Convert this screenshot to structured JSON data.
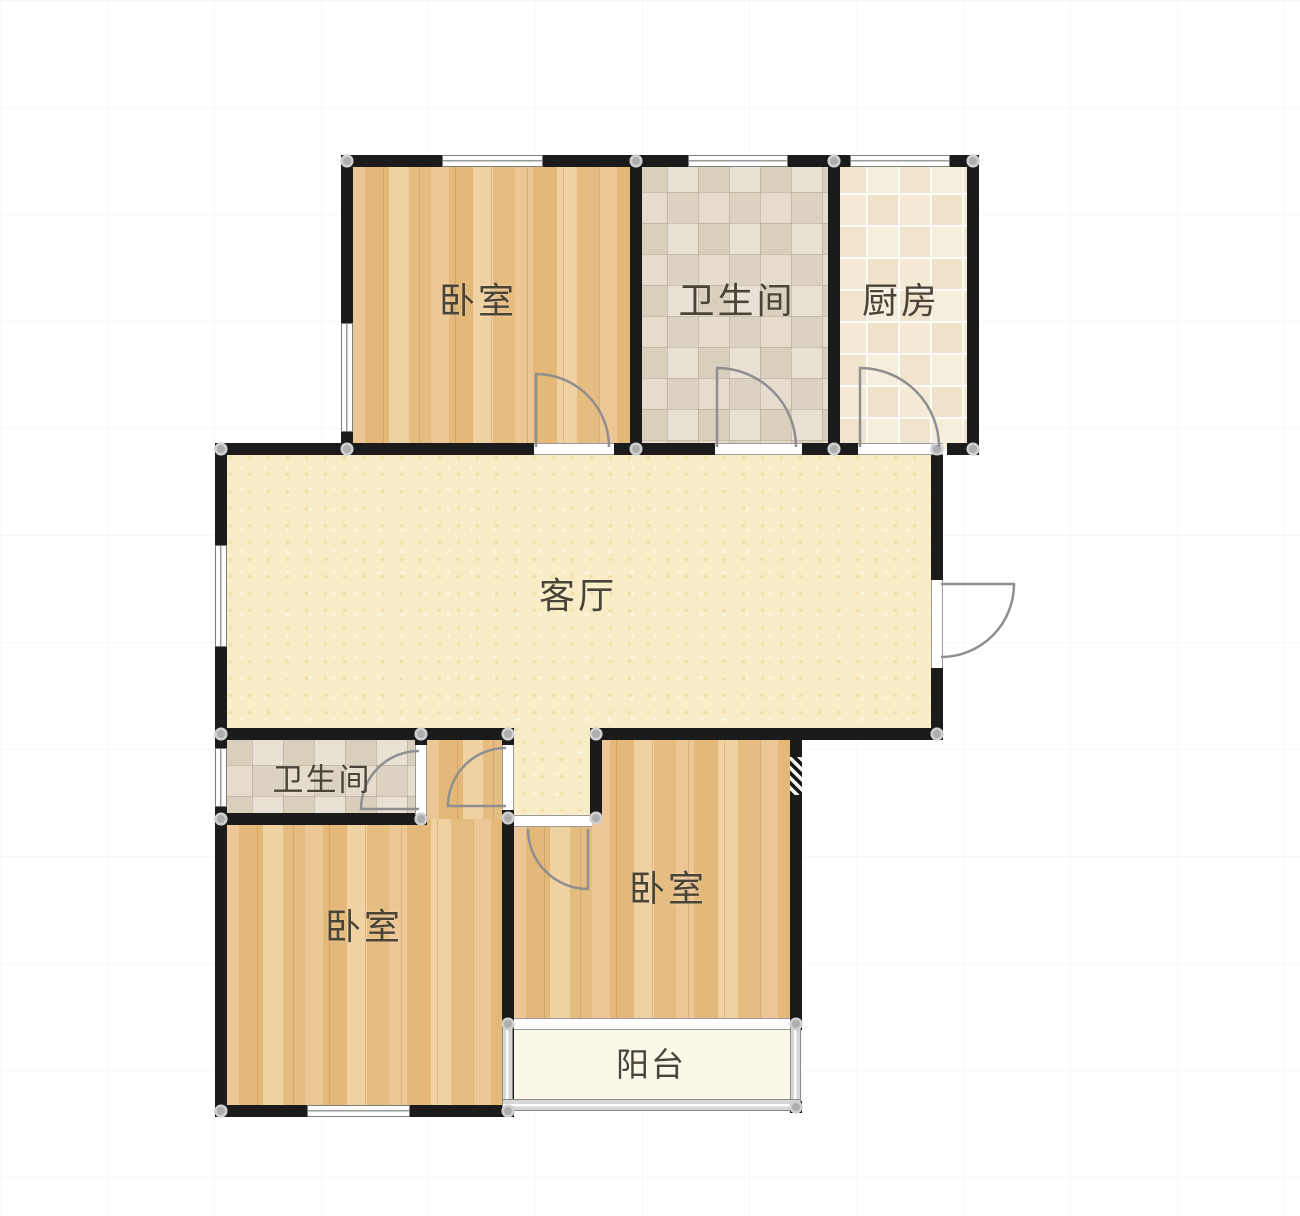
{
  "rooms": {
    "bedroom_top_left": {
      "label": "卧室"
    },
    "bathroom_top": {
      "label": "卫生间"
    },
    "kitchen": {
      "label": "厨房"
    },
    "living_room": {
      "label": "客厅"
    },
    "bathroom_lower": {
      "label": "卫生间"
    },
    "bedroom_lower_left": {
      "label": "卧室"
    },
    "bedroom_lower_right": {
      "label": "卧室"
    },
    "balcony": {
      "label": "阳台"
    }
  },
  "colors": {
    "wall": "#1b1b1b",
    "label_text": "#4a4436",
    "wood_floor": "#e9c48c",
    "bath_tile": "#e2d9c9",
    "kitchen_tile": "#f4ebd9",
    "living_floor": "#f8edc6",
    "balcony_floor": "#fbf8e9",
    "window_frame": "#7d7d7d",
    "door_line": "#8f8f8f"
  }
}
